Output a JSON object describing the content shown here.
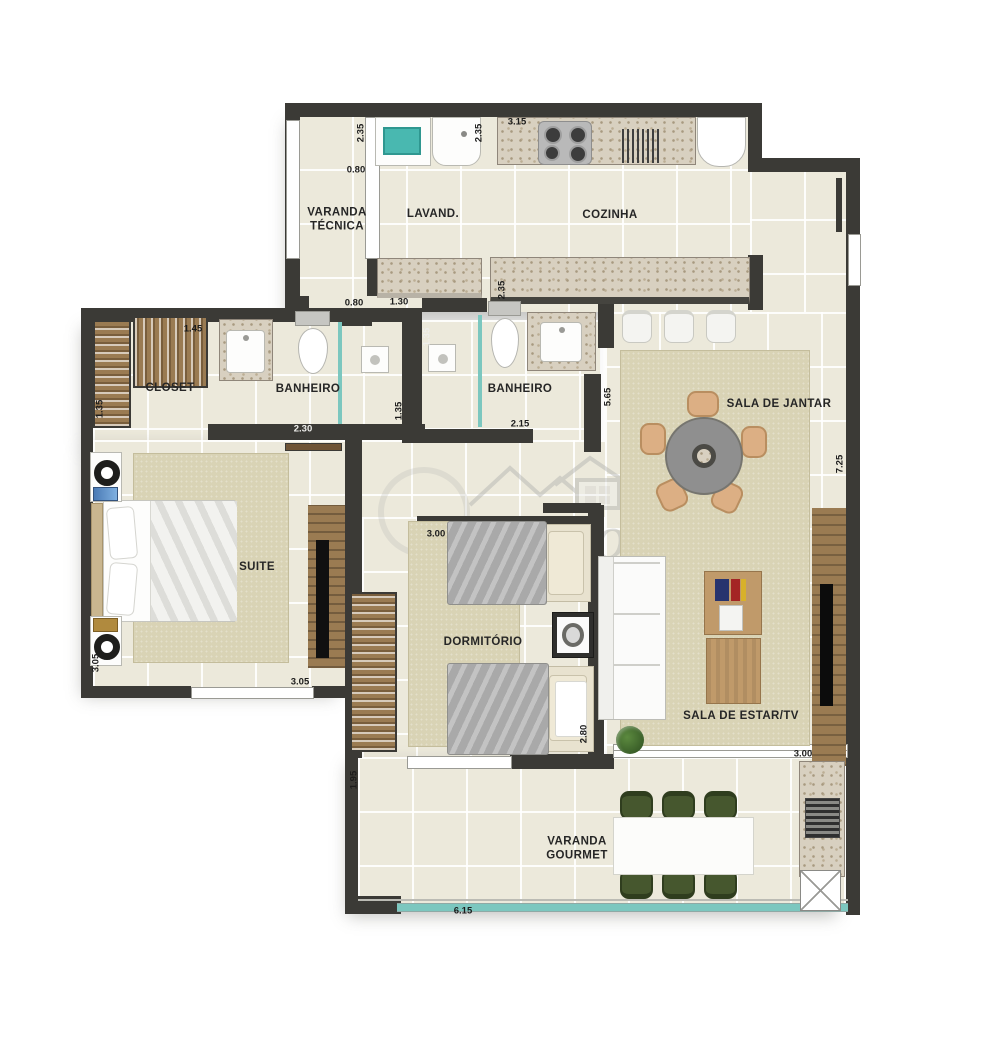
{
  "watermark": {
    "text": "Quecos"
  },
  "rooms": {
    "varanda_tecnica": "VARANDA\nTÉCNICA",
    "lavand": "LAVAND.",
    "cozinha": "COZINHA",
    "closet": "CLOSET",
    "banheiro1": "BANHEIRO",
    "banheiro2": "BANHEIRO",
    "sala_jantar": "SALA DE JANTAR",
    "suite": "SUITE",
    "dormitorio": "DORMITÓRIO",
    "sala_estar": "SALA DE ESTAR/TV",
    "varanda_gourmet": "VARANDA\nGOURMET"
  },
  "dims": {
    "varanda_tecnica_height": "2.35",
    "varanda_tecnica_width": "0.80",
    "lavand_height": "2.35",
    "cozinha_width": "3.15",
    "cozinha_depth": "2.35",
    "varanda_tecnica_door": "0.80",
    "lavand_width": "1.30",
    "closet_width": "1.45",
    "closet_depth": "1.35",
    "banheiro1_width": "2.30",
    "banheiro1_depth": "1.35",
    "banheiro2_depth": "1.35",
    "banheiro2_width": "2.15",
    "jantar_depth": "5.65",
    "right_side": "7.25",
    "dormitorio_width": "3.00",
    "dormitorio_depth": "2.80",
    "suite_width": "3.05",
    "suite_depth": "3.05",
    "varanda_depth": "1.95",
    "varanda_width": "6.15",
    "estar_width": "3.00"
  },
  "colors": {
    "wall": "#3b3a36",
    "floor": "#ece9db",
    "granite": "#d8d0c0",
    "rug": "#d9d3b5",
    "glass_teal": "#7cc7bf",
    "chair_green": "#46572e",
    "chair_peach": "#dcaf84",
    "table_gray": "#8f8f8f",
    "blanket_gray": "#a9a9a9",
    "wood": "#9a7b52"
  }
}
